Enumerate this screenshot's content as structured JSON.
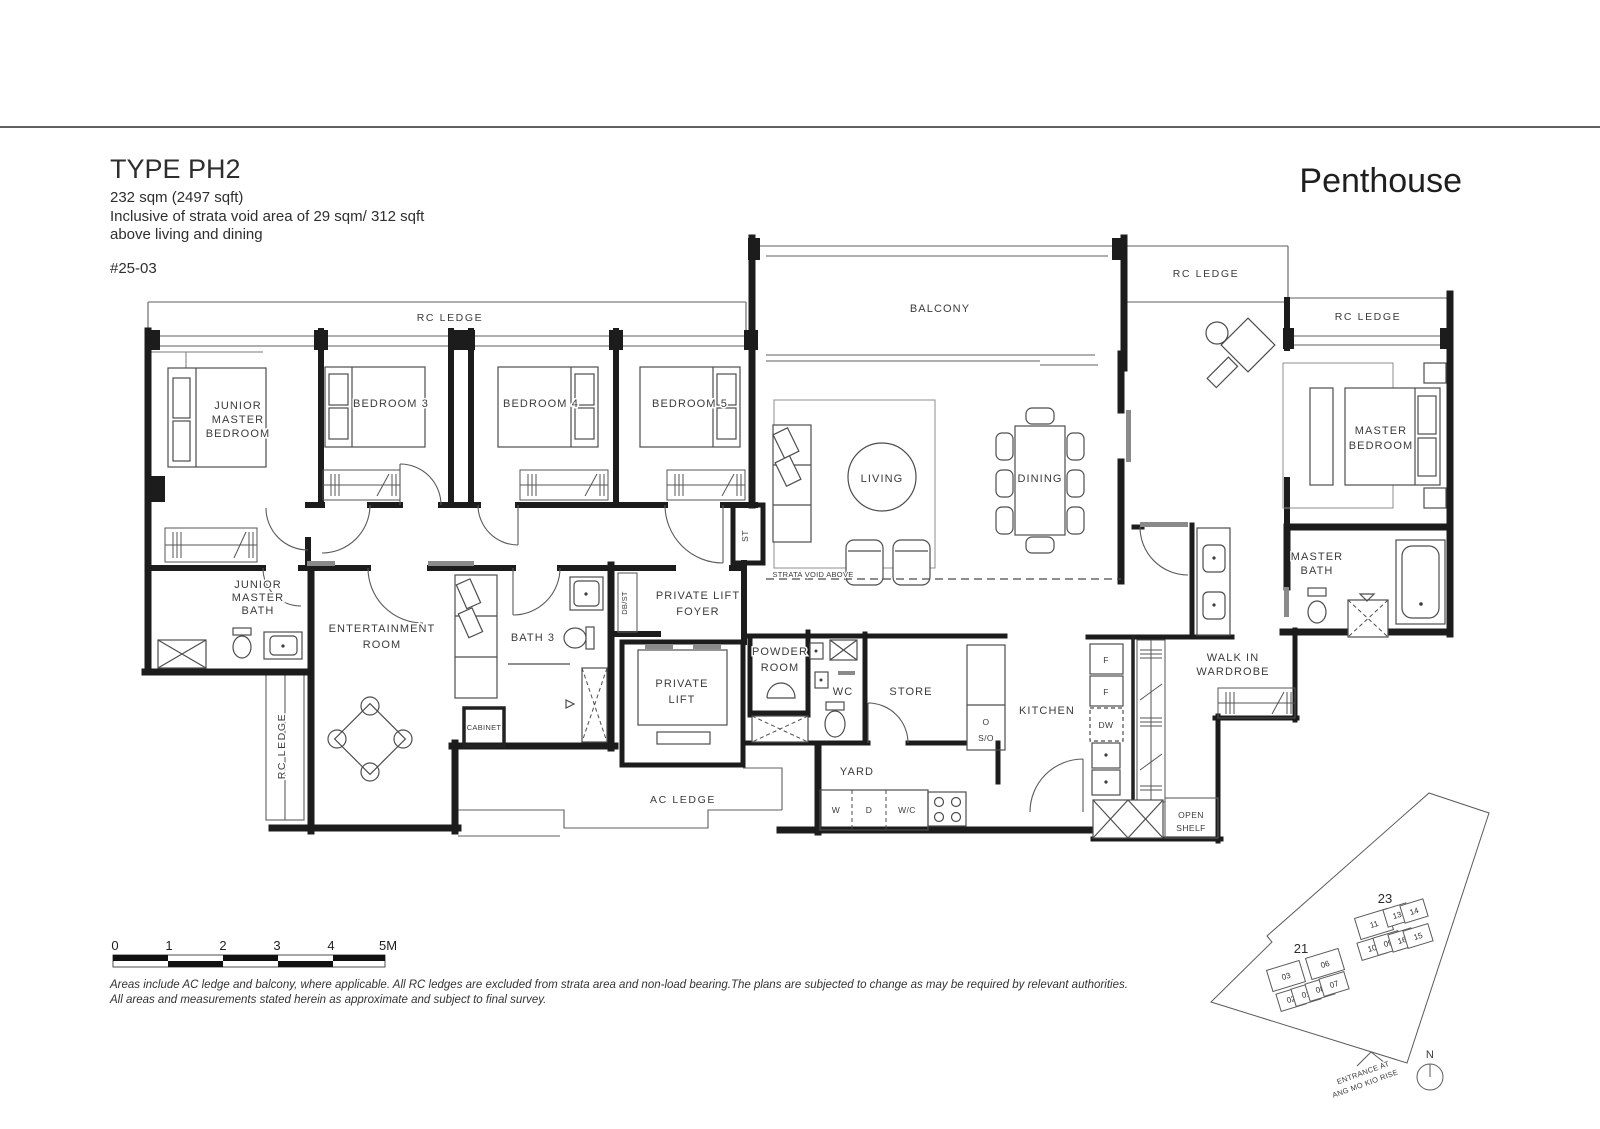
{
  "header": {
    "type_title": "TYPE PH2",
    "area": "232 sqm (2497 sqft)",
    "strata_1": "Inclusive of strata void area of 29 sqm/ 312 sqft",
    "strata_2": "above living and dining",
    "unit_no": "#25-03",
    "plan_category": "Penthouse"
  },
  "rooms": {
    "junior_master_bedroom": [
      "JUNIOR",
      "MASTER",
      "BEDROOM"
    ],
    "bedroom3": "BEDROOM 3",
    "bedroom4": "BEDROOM 4",
    "bedroom5": "BEDROOM 5",
    "balcony": "BALCONY",
    "living": "LIVING",
    "dining": "DINING",
    "master_bedroom": [
      "MASTER",
      "BEDROOM"
    ],
    "master_bath": [
      "MASTER",
      "BATH"
    ],
    "walk_in_wardrobe": [
      "WALK IN",
      "WARDROBE"
    ],
    "junior_master_bath": [
      "JUNIOR",
      "MASTER",
      "BATH"
    ],
    "entertainment_room": [
      "ENTERTAINMENT",
      "ROOM"
    ],
    "bath3": "BATH 3",
    "private_lift_foyer": [
      "PRIVATE LIFT",
      "FOYER"
    ],
    "private_lift": [
      "PRIVATE",
      "LIFT"
    ],
    "powder_room": [
      "POWDER",
      "ROOM"
    ],
    "wc": "WC",
    "store": "STORE",
    "kitchen": "KITCHEN",
    "yard": "YARD",
    "open_shelf": [
      "OPEN",
      "SHELF"
    ],
    "cabinet": "CABINET",
    "st": "ST",
    "db_st": "DB/ST",
    "strata_void": "STRATA VOID ABOVE"
  },
  "ledges": {
    "rc": "RC LEDGE",
    "ac": "AC LEDGE"
  },
  "appliances": {
    "f": "F",
    "dw": "DW",
    "w": "W",
    "d": "D",
    "wc": "W/C",
    "o": "O",
    "so": "S/O"
  },
  "scale": {
    "ticks": [
      "0",
      "1",
      "2",
      "3",
      "4",
      "5M"
    ]
  },
  "notes": [
    "Areas include AC ledge and balcony, where applicable. All RC ledges are excluded from strata area and non-load bearing.The plans are subjected to change as may be required by relevant authorities.",
    "All areas and measurements stated herein as approximate and subject to final survey."
  ],
  "site": {
    "block21": "21",
    "block23": "23",
    "units": [
      "03",
      "06",
      "02",
      "01",
      "08",
      "07",
      "11",
      "13",
      "14",
      "10",
      "09",
      "16",
      "15"
    ],
    "highlight_color": "#c3c3c3",
    "north": "N",
    "entrance": [
      "ENTRANCE AT",
      "ANG MO KIO RISE"
    ]
  }
}
